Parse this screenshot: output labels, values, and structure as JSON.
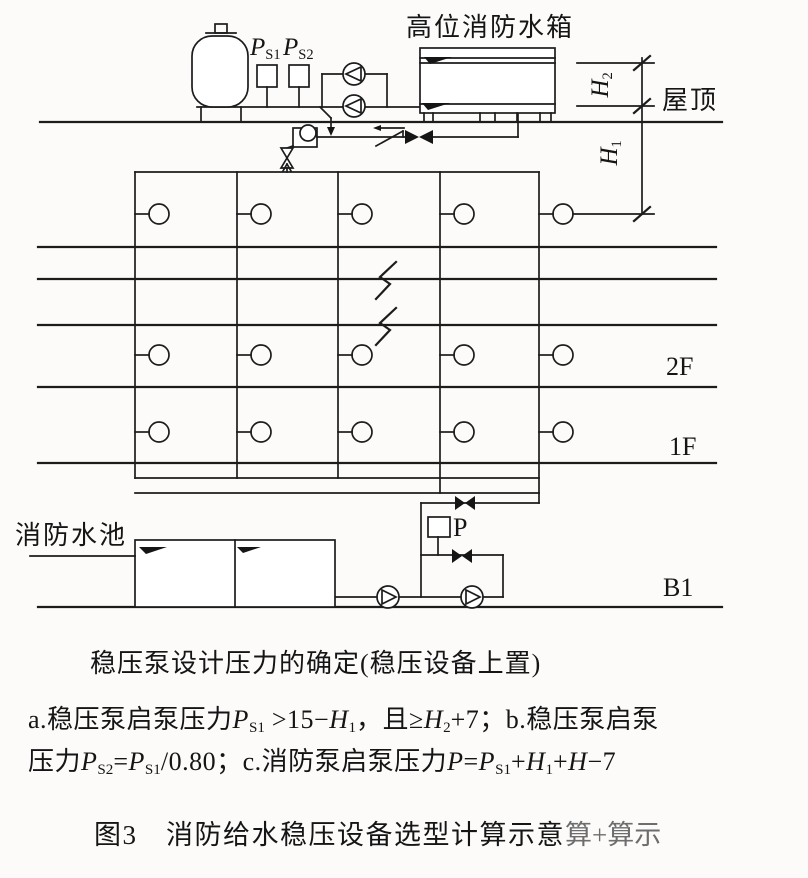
{
  "colors": {
    "line": "#1c1c1c",
    "text": "#151515",
    "ghost": "#4a4a4a",
    "background": "#fcfbfa"
  },
  "diagram": {
    "elevated_tank_label": "高位消防水箱",
    "roof_label": "屋顶",
    "floor_labels": {
      "f2": "2F",
      "f1": "1F",
      "b1": "B1"
    },
    "pool_label": "消防水池",
    "pump_pressure_switch_label": "P",
    "ps1": [
      {
        "t": "P",
        "s": "i"
      },
      {
        "t": "S1",
        "s": "sub"
      }
    ],
    "ps2": [
      {
        "t": "P",
        "s": "i"
      },
      {
        "t": "S2",
        "s": "sub"
      }
    ],
    "h2": [
      {
        "t": "H",
        "s": "i"
      },
      {
        "t": "2",
        "s": "sub"
      }
    ],
    "h1": [
      {
        "t": "H",
        "s": "i"
      },
      {
        "t": "1",
        "s": "sub"
      }
    ]
  },
  "notes": {
    "heading": "稳压泵设计压力的确定(稳压设备上置)",
    "line_a": [
      {
        "t": "a.稳压泵启泵压力"
      },
      {
        "t": "P",
        "s": "i"
      },
      {
        "t": "S1",
        "s": "sub"
      },
      {
        "t": " >15−"
      },
      {
        "t": "H",
        "s": "i"
      },
      {
        "t": "1",
        "s": "sub"
      },
      {
        "t": "，且≥"
      },
      {
        "t": "H",
        "s": "i"
      },
      {
        "t": "2",
        "s": "sub"
      },
      {
        "t": "+7；b.稳压泵启泵"
      }
    ],
    "line_b": [
      {
        "t": "压力"
      },
      {
        "t": "P",
        "s": "i"
      },
      {
        "t": "S2",
        "s": "sub"
      },
      {
        "t": "="
      },
      {
        "t": "P",
        "s": "i"
      },
      {
        "t": "S1",
        "s": "sub"
      },
      {
        "t": "/0.80；c.消防泵启泵压力"
      },
      {
        "t": "P",
        "s": "i"
      },
      {
        "t": "="
      },
      {
        "t": "P",
        "s": "i"
      },
      {
        "t": "S1",
        "s": "sub"
      },
      {
        "t": "+"
      },
      {
        "t": "H",
        "s": "i"
      },
      {
        "t": "1",
        "s": "sub"
      },
      {
        "t": "+"
      },
      {
        "t": "H",
        "s": "i"
      },
      {
        "t": "−7"
      }
    ],
    "caption": "图3　消防给水稳压设备选型计算示意",
    "caption_ghost": "算+算示"
  }
}
